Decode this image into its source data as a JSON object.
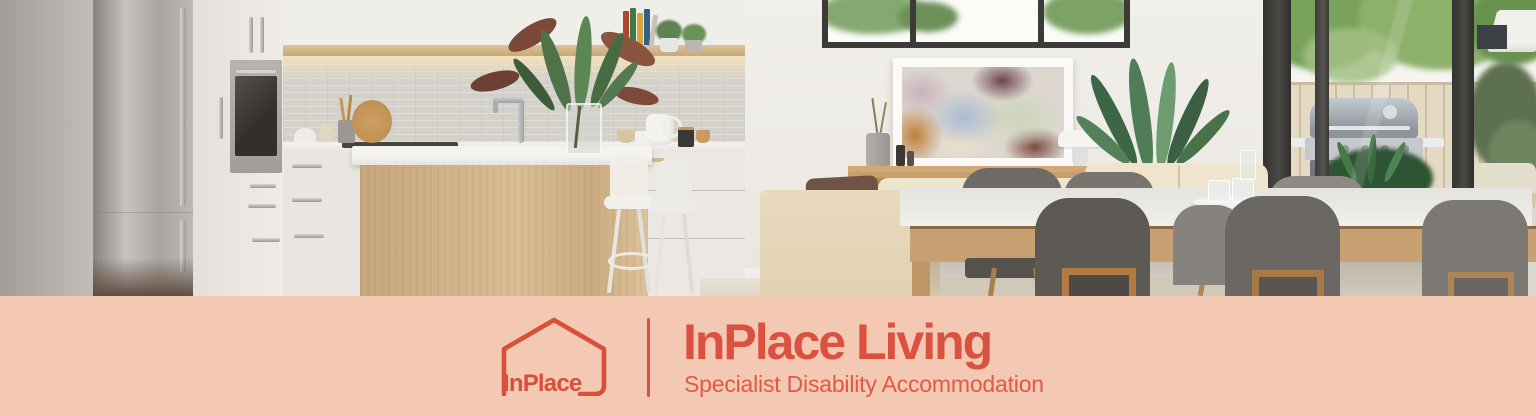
{
  "brand": {
    "logo_text": "InPlace",
    "title": "InPlace Living",
    "subtitle": "Specialist Disability Accommodation"
  },
  "colors": {
    "accent": "#db5140",
    "accent_light": "#e05a47",
    "band_background": "#f4c9b4"
  },
  "icons": {
    "logo": "house-outline-icon"
  },
  "photo": {
    "subject": "open-plan kitchen, dining and living room with outdoor patio"
  }
}
